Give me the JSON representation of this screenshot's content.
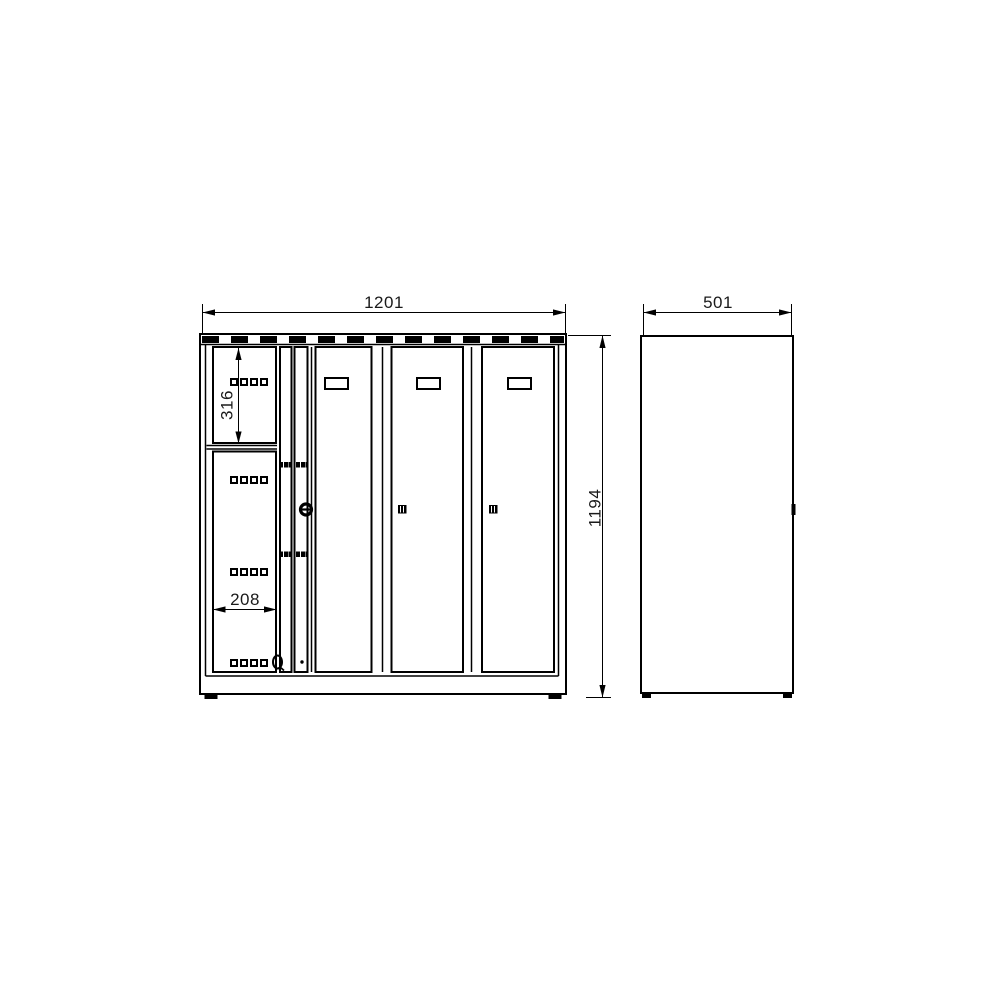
{
  "drawing": {
    "kind": "technical dimension drawing of a compartment locker cabinet, front and side views",
    "dimensions": {
      "overall_width": "1201",
      "overall_height": "1194",
      "depth": "501",
      "upper_compartment_height": "316",
      "compartment_width": "208"
    },
    "colors": {
      "line": "#000000",
      "text": "#1a1a1a",
      "background": "#ffffff"
    },
    "icons": {
      "vent-slots-icon": "dashed black strip",
      "cylinder-lock-icon": "ring with horizontal key slot",
      "door-lock-icon": "small black square with slits",
      "handle-slot-icon": "outlined rectangle",
      "perforation-hole-icon": "small outlined square",
      "hinge-mark-icon": "black tick group",
      "foot-icon": "black block",
      "number-tag-icon": "small oval mark"
    }
  }
}
